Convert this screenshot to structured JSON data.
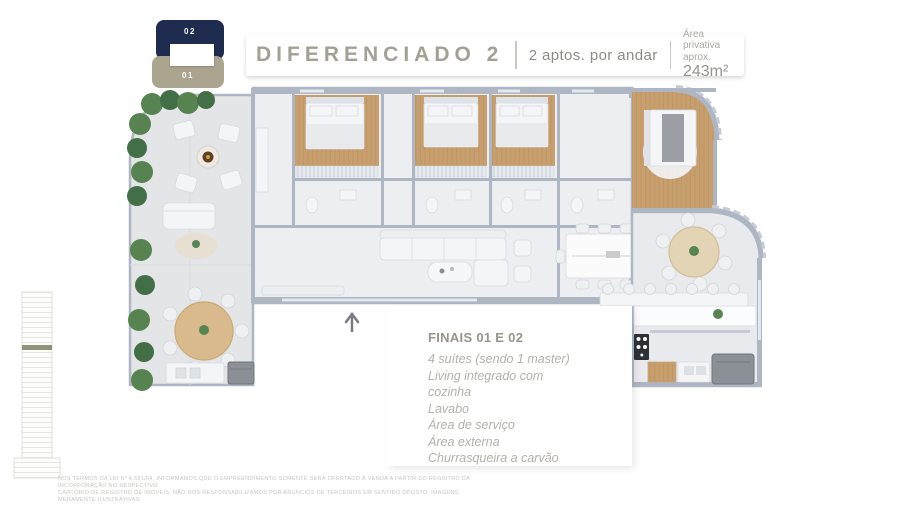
{
  "floor_badge": {
    "top": "02",
    "bottom": "01"
  },
  "header": {
    "title": "DIFERENCIADO 2",
    "subtitle": "2 aptos. por andar",
    "area_label": "Área privativa aprox.",
    "area_value": "243m²"
  },
  "info_card": {
    "heading": "FINAIS 01 E 02",
    "features": [
      "4 suítes (sendo 1 master)",
      "Living integrado com",
      "cozinha",
      "Lavabo",
      "Área de serviço",
      "Área externa",
      "Churrasqueira a carvão"
    ]
  },
  "disclaimer": {
    "line1": "NOS TERMOS DA LEI Nº 4.591/64, INFORMAMOS QUE O EMPREENDIMENTO SOMENTE SERÁ OFERTADO À VENDA A PARTIR DO REGISTRO DA INCORPORAÇÃO NO RESPECTIVO",
    "line2": "CARTÓRIO DE REGISTRO DE IMÓVEIS. NÃO NOS RESPONSABILIZAMOS POR ANÚNCIOS DE TERCEIROS EM SENTIDO OPOSTO. IMAGENS MERAMENTE ILUSTRATIVAS."
  },
  "colors": {
    "navy": "#1e2c4f",
    "taupe": "#aba58f",
    "title_gray": "#a3a096",
    "text_gray": "#8d8d88",
    "heading_text": "#98958c",
    "feature_text": "#b3b1a8",
    "disclaimer": "#c5c5c0",
    "wall": "#aeb6c3",
    "floor_interior": "#edeef2",
    "floor_terrace": "#e4e5e7",
    "wood": "#c79e6e",
    "wood_line": "#b68a55",
    "green": "#578351",
    "green_dark": "#436f46",
    "grill": "#8b9097"
  }
}
